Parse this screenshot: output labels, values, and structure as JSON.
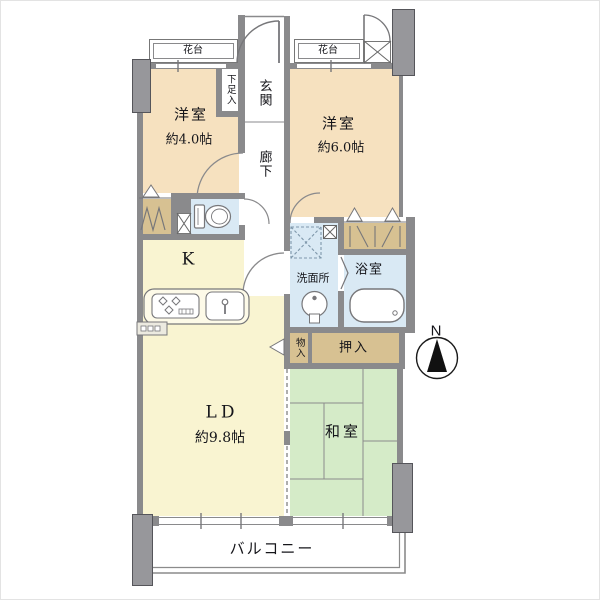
{
  "plan_title": "2LDK apartment floor plan",
  "rooms": {
    "western_a": {
      "label": "洋室",
      "size": "約4.0帖"
    },
    "western_b": {
      "label": "洋室",
      "size": "約6.0帖"
    },
    "kitchen": {
      "label": "K"
    },
    "living_dining": {
      "label": "LD",
      "size": "約9.8帖"
    },
    "japanese_room": {
      "label": "和室"
    },
    "washroom": {
      "label": "洗面所"
    },
    "bathroom": {
      "label": "浴室"
    },
    "entrance": {
      "label": "玄関"
    },
    "hallway": {
      "label": "廊下"
    },
    "shoe_cabinet": {
      "label": "下足入"
    },
    "oshiire_closet": {
      "label": "押入"
    },
    "monoire_storage": {
      "label": "物入"
    },
    "balcony": {
      "label": "バルコニー"
    },
    "flower_stand_left": {
      "label": "花台"
    },
    "flower_stand_right": {
      "label": "花台"
    }
  },
  "compass": {
    "north": "N"
  },
  "icons": {
    "toilet": "toilet-icon",
    "washbasin": "washbasin-icon",
    "bathtub": "bathtub-icon",
    "stove": "stove-icon",
    "sink": "sink-icon",
    "washer_pan": "washer-pan-icon",
    "pipe_space": "pipe-space-x-icon",
    "duct": "duct-x-icon",
    "compass": "compass-north-icon"
  },
  "colors": {
    "western_room": "#F6E1BF",
    "kitchen_living": "#F9F4D1",
    "japanese_room": "#D5EBC8",
    "sanitary": "#D9E9F4",
    "closet": "#D7C192",
    "wall": "#8A8A8C",
    "pillar": "#97979B",
    "line": "#777777",
    "background": "#FFFFFF"
  }
}
